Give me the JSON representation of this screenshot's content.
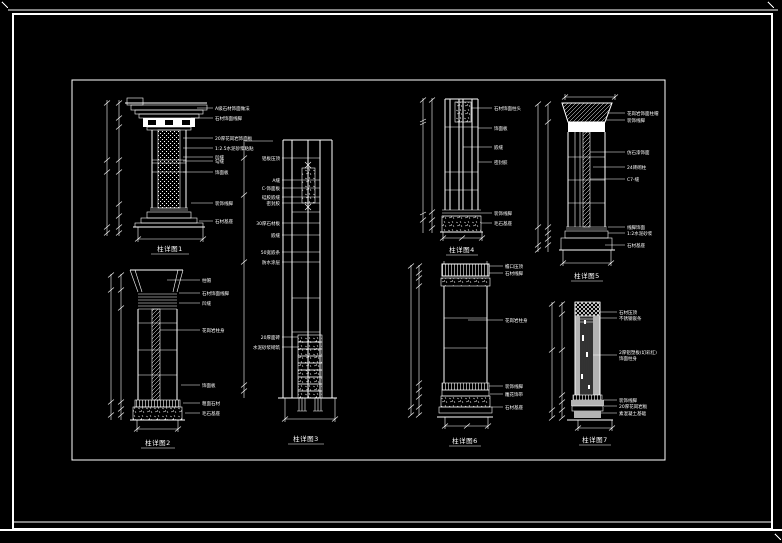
{
  "canvas": {
    "background": "#000000",
    "line_color": "#ffffff",
    "gray_fill": "#b3b3b3",
    "sheet_type": "CAD column details sheet"
  },
  "drawings": [
    {
      "name": "column-detail-1",
      "label": "柱详图1",
      "annotations": [
        "A级石材饰面做法",
        "石材饰面线脚",
        "20厚花岗岩饰面板",
        "1:2.5水泥砂浆粘贴",
        "凹缝",
        "勾缝",
        "饰面板",
        "装饰线脚",
        "石材基座"
      ]
    },
    {
      "name": "column-detail-2",
      "label": "柱详图2",
      "annotations": [
        "柱帽",
        "石材饰面线脚",
        "凹缝",
        "花岗岩柱身",
        "饰面板",
        "粗面石材",
        "毛石基座"
      ]
    },
    {
      "name": "column-detail-3",
      "label": "柱详图3",
      "annotations": [
        "铝板压顶",
        "A缝",
        "C-饰面板",
        "硅胶嵌缝",
        "密封胶",
        "30厚石材板",
        "嵌缝",
        "50宽嵌条",
        "防水涂层",
        "20厚面砖",
        "水泥砂浆砌筑"
      ]
    },
    {
      "name": "column-detail-4",
      "label": "柱详图4",
      "annotations": [
        "石材饰面柱头",
        "饰面板",
        "嵌缝",
        "密封胶",
        "装饰线脚",
        "毛石基座"
      ]
    },
    {
      "name": "column-detail-5",
      "label": "柱详图5",
      "annotations": [
        "花岗岩饰面柱帽",
        "装饰线脚",
        "仿石漆饰面",
        "24砖砌柱",
        "C7-缝",
        "线脚饰面",
        "1:2水泥砂浆",
        "石材基座"
      ]
    },
    {
      "name": "column-detail-6",
      "label": "柱详图6",
      "annotations": [
        "檐口压顶",
        "石材线脚",
        "花岗岩柱身",
        "装饰线脚",
        "雕花饰带",
        "石材基座"
      ]
    },
    {
      "name": "column-detail-7",
      "label": "柱详图7",
      "annotations": [
        "石材压顶",
        "不锈钢嵌条",
        "2厚铝塑板(幻彩红)",
        "饰面柱身",
        "装饰线脚",
        "20厚花岗岩板",
        "素混凝土基础"
      ]
    }
  ]
}
